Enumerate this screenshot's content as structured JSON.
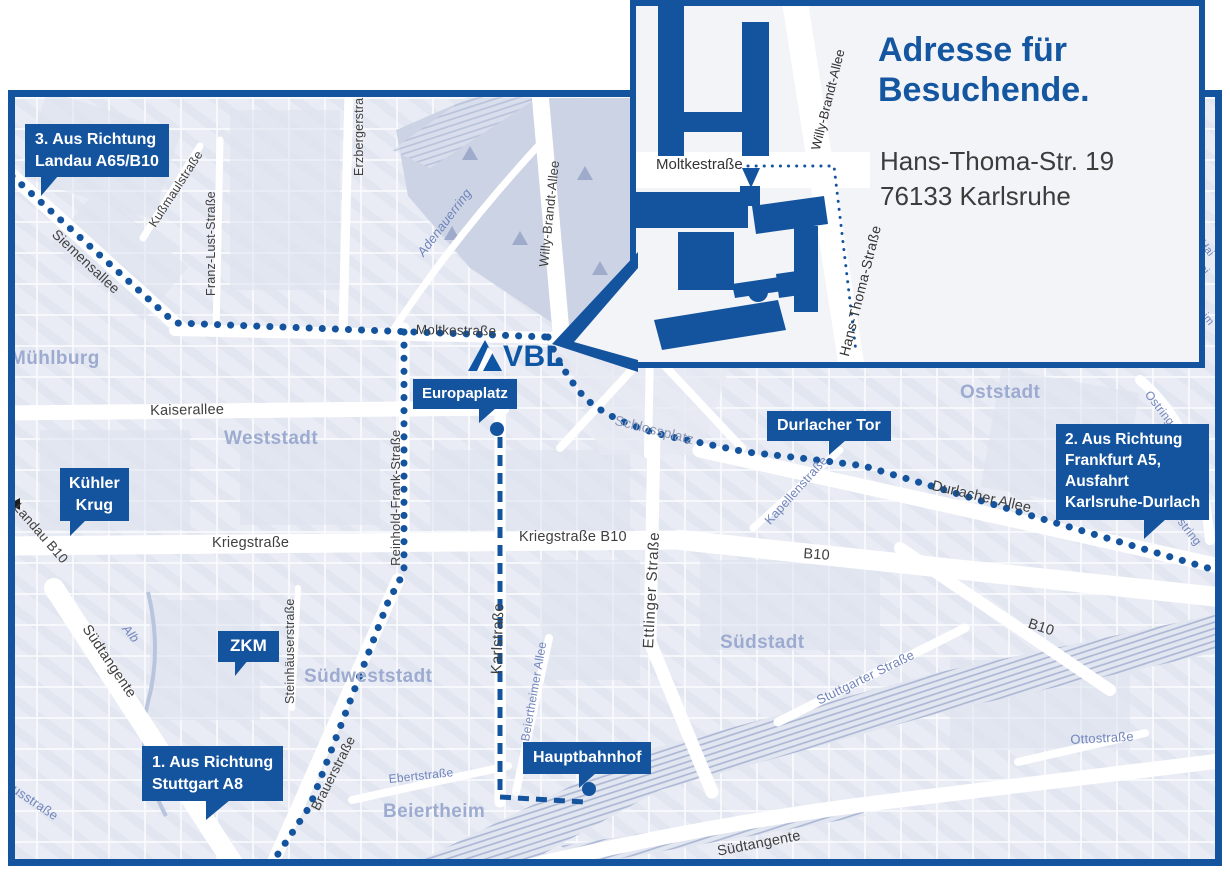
{
  "inset": {
    "title": "Adresse für\nBesuchende.",
    "address": "Hans-Thoma-Str. 19\n76133 Karlsruhe",
    "streets": {
      "moltkestrasse": "Moltkestraße",
      "willy_brandt_allee": "Willy-Brandt-Allee",
      "hans_thoma_strasse": "Hans-Thoma-Straße"
    }
  },
  "logo": {
    "text": "VBL"
  },
  "badges": {
    "route3": "3. Aus Richtung\nLandau A65/B10",
    "route2": "2. Aus Richtung\nFrankfurt A5,\nAusfahrt\nKarlsruhe-Durlach",
    "route1": "1. Aus Richtung\nStuttgart A8",
    "europaplatz": "Europaplatz",
    "durlacher_tor": "Durlacher Tor",
    "kuehler_krug": "Kühler\nKrug",
    "zkm": "ZKM",
    "hauptbahnhof": "Hauptbahnhof"
  },
  "areas": {
    "muehlburg": "Mühlburg",
    "weststadt": "Weststadt",
    "oststadt": "Oststadt",
    "suedstadt": "Südstadt",
    "suedweststadt": "Südweststadt",
    "beiertheim": "Beiertheim"
  },
  "streets": {
    "siemensallee": "Siemensallee",
    "kussmaulstrasse": "Kußmaulstraße",
    "franz_lust_strasse": "Franz-Lust-Straße",
    "erzbergerstrasse": "Erzbergerstraße",
    "willy_brandt_allee": "Willy-Brandt-Allee",
    "adenauerring": "Adenauerring",
    "moltkestrasse": "Moltkestraße",
    "kaiserallee": "Kaiserallee",
    "reinhold_frank_strasse": "Reinhold-Frank-Straße",
    "kriegstrasse": "Kriegstraße",
    "kriegstrasse_b10": "Kriegstraße B10",
    "karlstrasse": "Karlstraße",
    "ettlinger_strasse": "Ettlinger Straße",
    "schlossplatz": "Schlossplatz",
    "kapellenstrasse": "Kapellenstraße",
    "durlacher_allee": "Durlacher Allee",
    "b10_west": "B10",
    "b10_east": "B10",
    "ostring_north": "Ostring",
    "ostring_south": "Ostring",
    "landau_b10": "Landau B10",
    "suedtangente_west": "Südtangente",
    "suedtangente_east": "Südtangente",
    "alb": "Alb",
    "steinhaeuserstrasse": "Steinhäuserstraße",
    "brauerstrasse": "Brauerstraße",
    "ebertstrasse": "Ebertstraße",
    "beiertheimer_allee": "Beiertheimer Allee",
    "stuttgarter_strasse": "Stuttgarter Straße",
    "pulverhausstrasse": "Pulverhausstraße",
    "ottostrasse": "Ottostraße",
    "sliver1": "Hai",
    "sliver2": "wei",
    "sliver3": "eim"
  },
  "colors": {
    "primary_blue": "#14549e",
    "logo_blue": "#0e55a3",
    "map_background": "#e9ecf4",
    "park_fill": "#ccd3e5",
    "area_label": "#9dabd0",
    "street_label": "#3f3f3f",
    "minor_street_blue": "#7185bb",
    "inset_background": "#f3f4f8"
  }
}
